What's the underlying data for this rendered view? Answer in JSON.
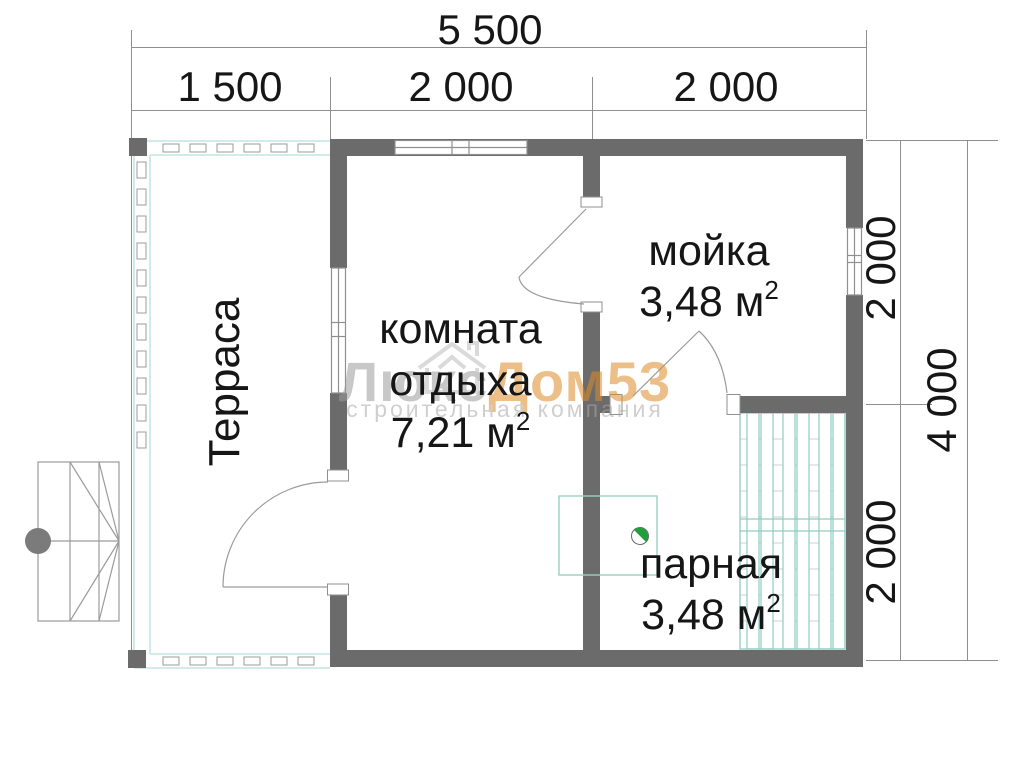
{
  "dimensions": {
    "top_total": "5 500",
    "top_segments": [
      "1 500",
      "2 000",
      "2 000"
    ],
    "right_inner_segments": [
      "2 000",
      "2 000"
    ],
    "right_total": "4 000"
  },
  "rooms": {
    "terrace": {
      "name": "Терраса"
    },
    "rest_room": {
      "line1": "комната",
      "line2": "отдыха",
      "area": "7,21 м",
      "area_sup": "2"
    },
    "washing": {
      "name": "мойка",
      "area": "3,48 м",
      "area_sup": "2"
    },
    "steam": {
      "name": "парная",
      "area": "3,48 м",
      "area_sup": "2"
    }
  },
  "watermark": {
    "brand_part1": "Люкс",
    "brand_part2": "Дом53",
    "subtitle": "строительная компания"
  },
  "colors": {
    "wall": "#6b6b6b",
    "drawing_line": "#8f8f8f",
    "terrace_accent": "#c2e4e4",
    "bench_accent": "#8fccc2",
    "stove_green": "#1f9e3e",
    "watermark_orange": "#de8b28",
    "watermark_gray": "#9c9c9c"
  }
}
